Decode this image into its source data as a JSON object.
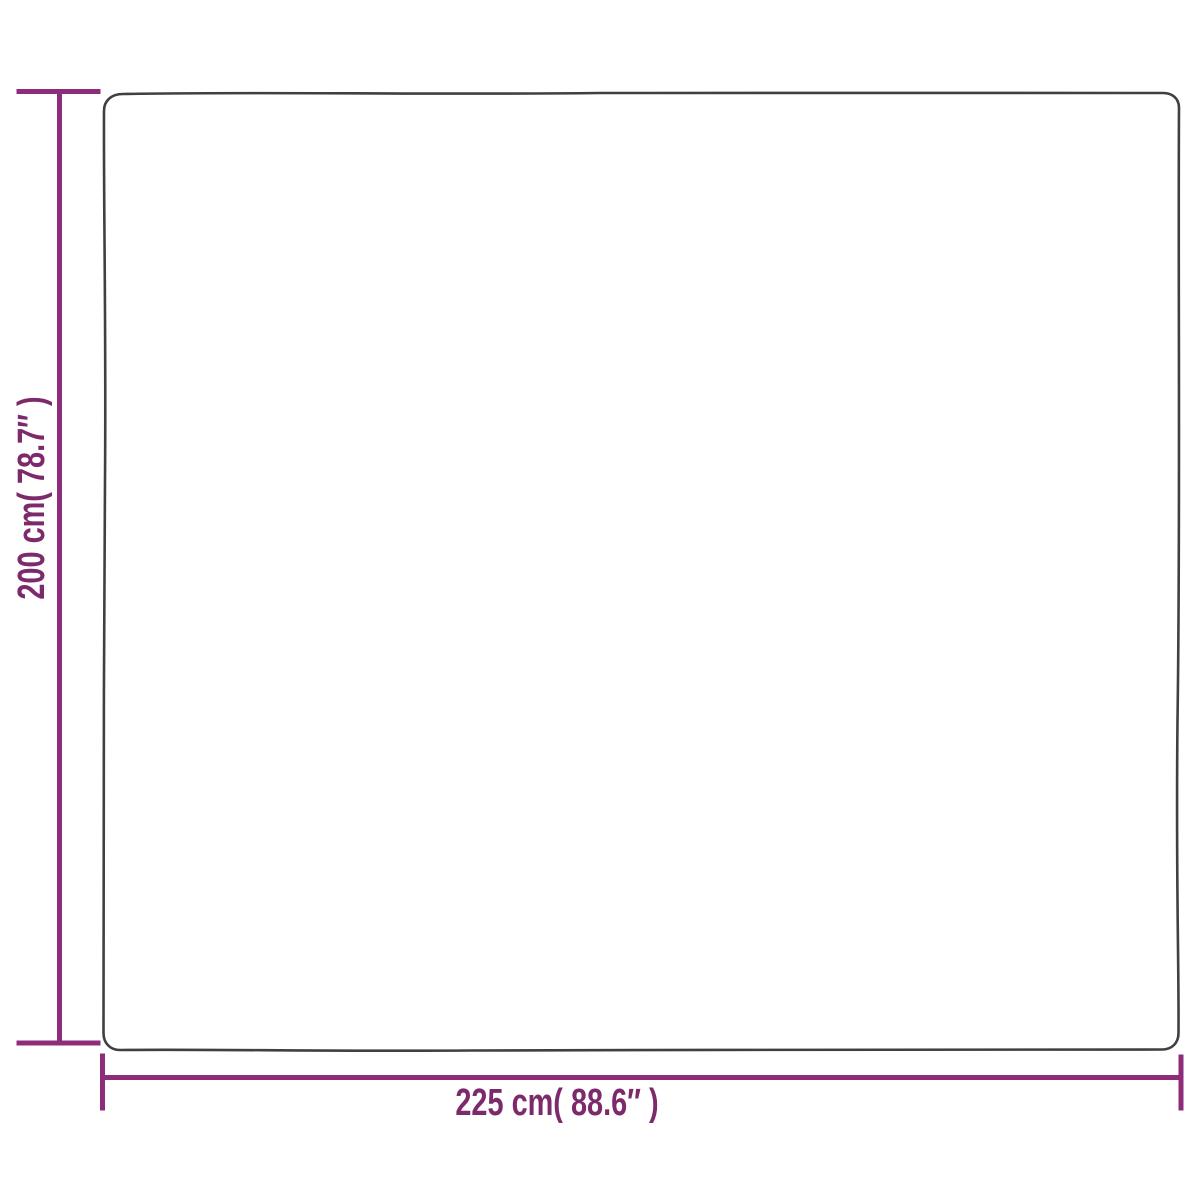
{
  "diagram": {
    "height_dimension": {
      "label": "200 cm( 78.7″ )",
      "value_cm": "200",
      "value_in": "78.7"
    },
    "width_dimension": {
      "label": "225 cm( 88.6″ )",
      "value_cm": "225",
      "value_in": "88.6"
    },
    "colors": {
      "dimension_line": "#8e2c79",
      "dimension_text": "#7c2a6b",
      "product_outline": "#404040",
      "background": "#ffffff"
    }
  }
}
